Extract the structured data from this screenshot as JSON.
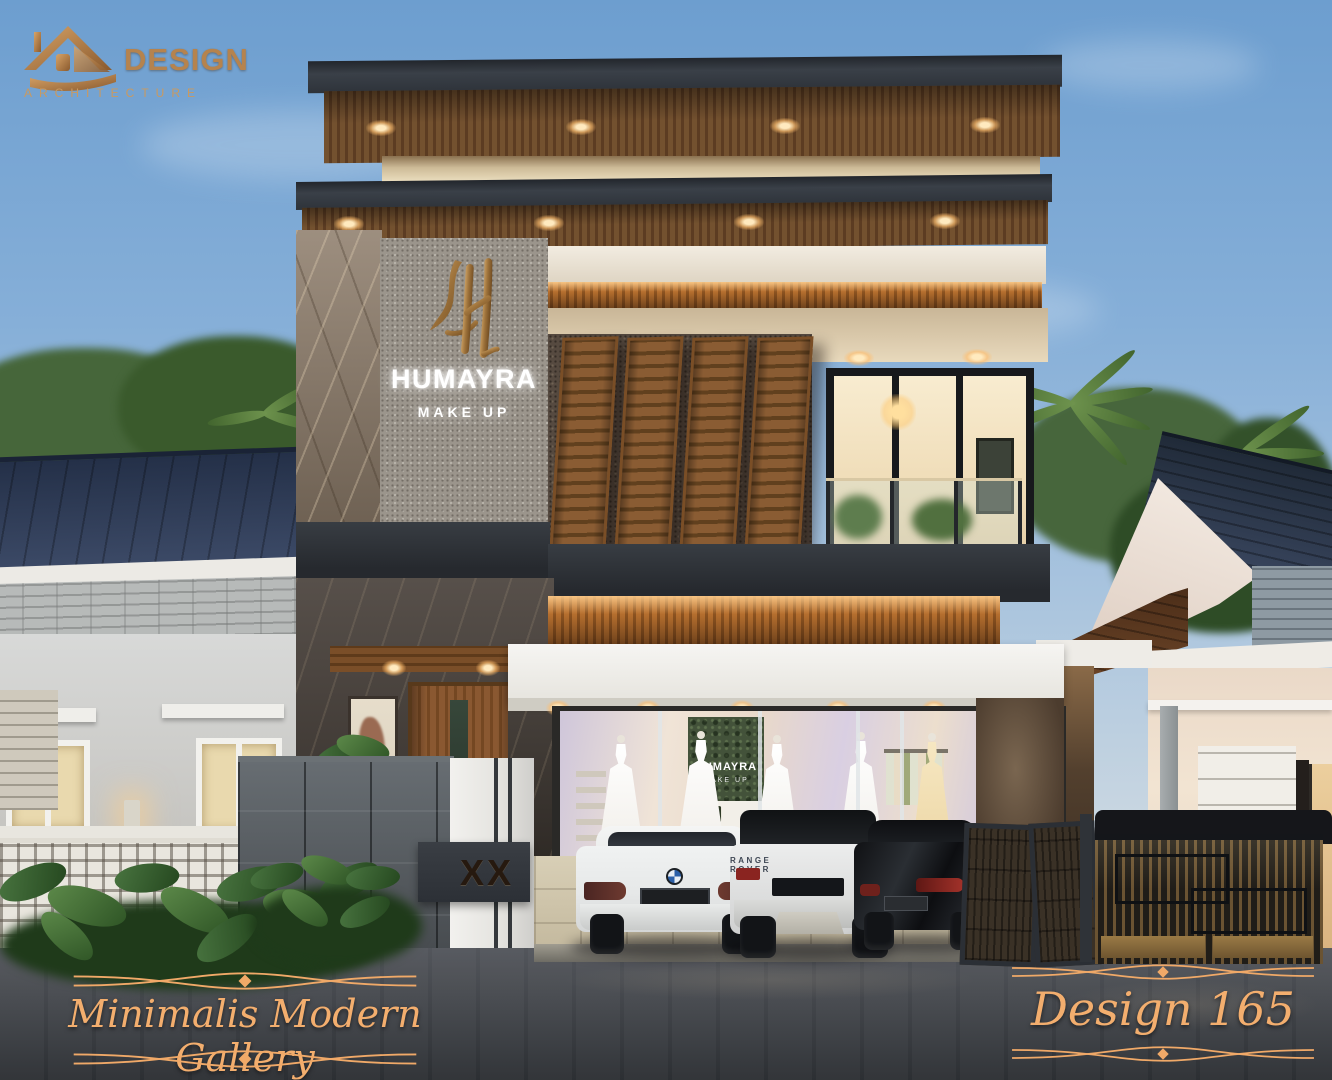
{
  "logo": {
    "brand": "DESIGN",
    "subtitle": "ARCHITECTURE"
  },
  "building_sign": {
    "name": "HUMAYRA",
    "line2": "MAKE UP"
  },
  "interior_sign": {
    "name": "HUMAYRA",
    "line2": "MAKE UP"
  },
  "gate_pillar": {
    "house_number": "XX"
  },
  "vehicles": {
    "range_rover_badge": "RANGE ROVER"
  },
  "captions": {
    "left": "Minimalis Modern Gallery",
    "right": "Design 165"
  },
  "colors": {
    "logo_gold": "#b5834e",
    "caption_gold": "#f3ae6e",
    "sky_top": "#6d9ecf",
    "roof_fascia": "#343a41",
    "wood_soffit": "#6e4c30",
    "amber_backlight": "#b26f2f",
    "stone_grey": "#9b958c",
    "marble_brown": "#8d7c6a",
    "canopy_white": "#f1f0ec",
    "road_asphalt": "#3b3e43"
  }
}
